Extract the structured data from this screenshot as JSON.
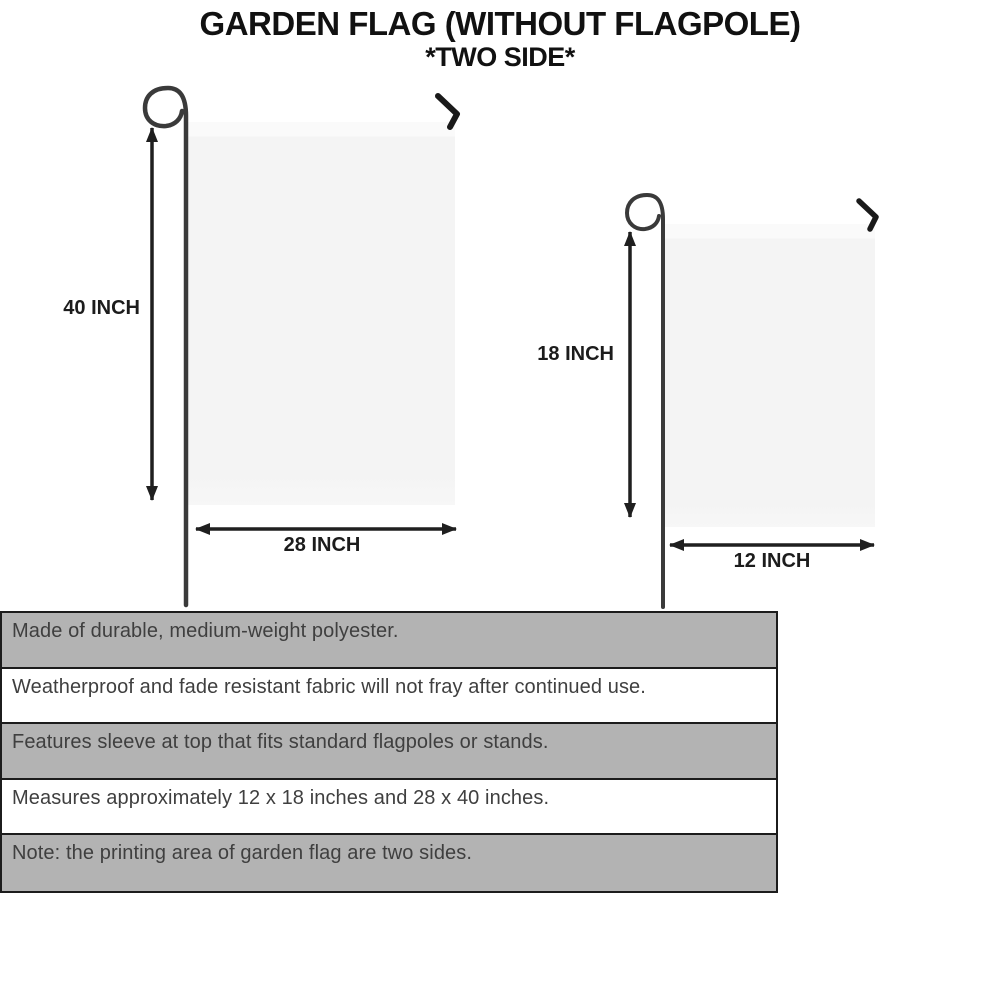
{
  "title": {
    "line1": "GARDEN FLAG (WITHOUT FLAGPOLE)",
    "line2": "*TWO SIDE*"
  },
  "large_flag": {
    "height_label": "40 INCH",
    "width_label": "28 INCH"
  },
  "small_flag": {
    "height_label": "18 INCH",
    "width_label": "12 INCH"
  },
  "features": [
    "Made of durable, medium-weight polyester.",
    "Weatherproof and fade resistant fabric will not fray after continued use.",
    "Features sleeve at top that fits standard flagpoles or stands.",
    "Measures approximately 12 x 18 inches and 28 x 40 inches.",
    "Note: the printing area of garden flag are two sides."
  ],
  "colors": {
    "row_gray": "#b3b3b3",
    "row_white": "#ffffff",
    "flag_fill": "#f4f4f4",
    "line_dark": "#1f1f1f",
    "pole_gray": "#3a3a3a",
    "feature_text": "#3f3f3f",
    "title_text": "#111111"
  }
}
